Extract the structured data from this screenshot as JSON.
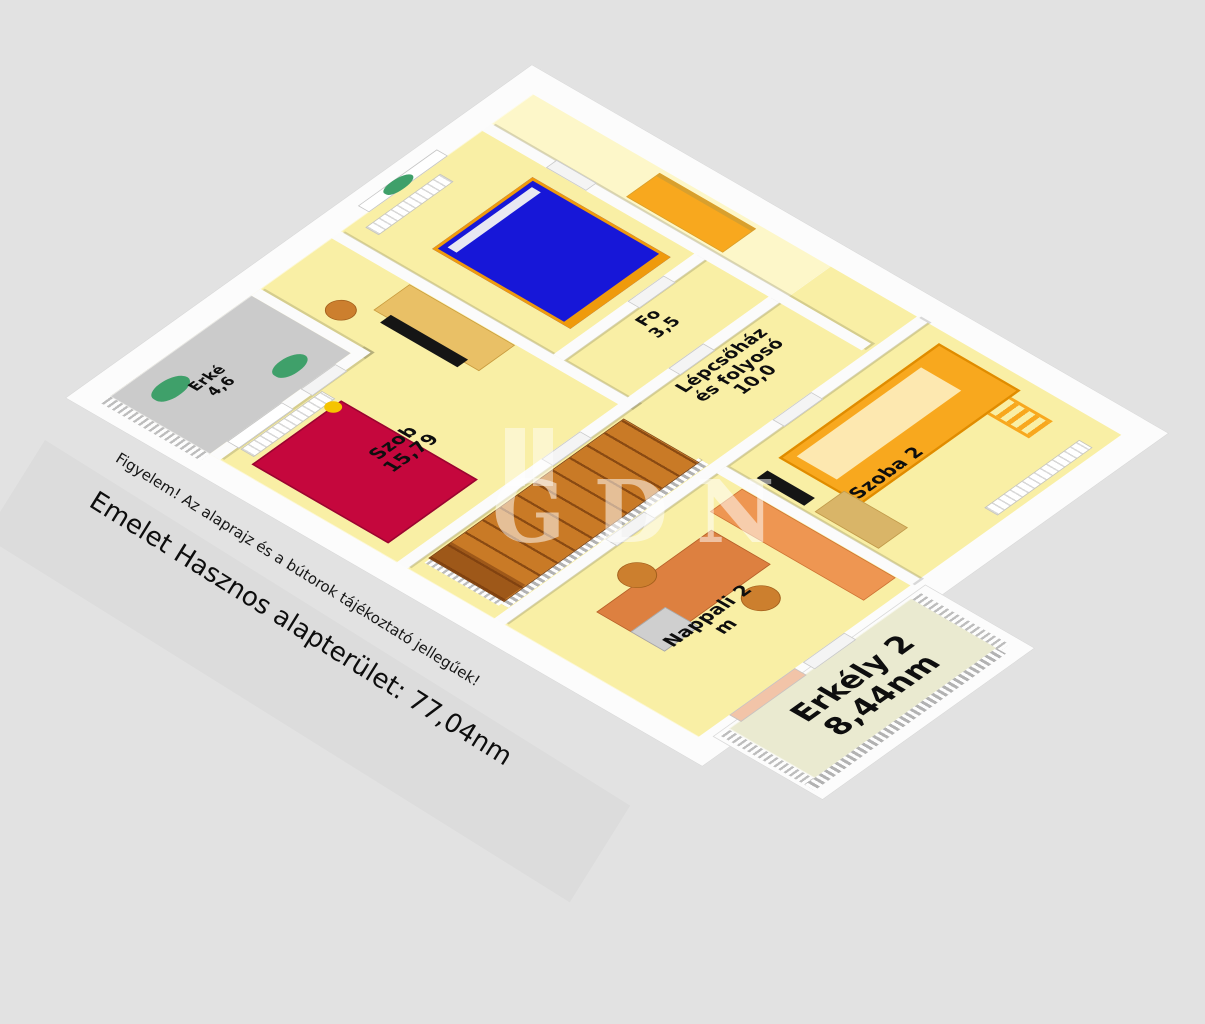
{
  "floorplan": {
    "watermark_text": "GDN",
    "notes": {
      "disclaimer": "Figyelem! Az alaprajz és a bútorok tájékoztató jellegűek!",
      "area_summary": "Emelet Hasznos alapterület: 77,04nm"
    },
    "rooms": [
      {
        "id": "erkely-1",
        "name": "Erké",
        "area": "4,6"
      },
      {
        "id": "szoba-1",
        "name": "Szob",
        "area": "15,79"
      },
      {
        "id": "fo",
        "name": "Fo",
        "area": "3,5"
      },
      {
        "id": "lepcsohaz",
        "name": "Lépcsőház",
        "name2": "és folyosó",
        "area": "10,0"
      },
      {
        "id": "szoba-2",
        "name": "Szoba 2",
        "area": ""
      },
      {
        "id": "nappali-2",
        "name": "Nappali 2",
        "area": "m"
      },
      {
        "id": "erkely-2",
        "name": "Erkély 2",
        "area": "8,44nm"
      }
    ],
    "colors": {
      "background": "#e2e2e2",
      "wall": "#fbfbfb",
      "floor": "#f9efa5",
      "floor_light": "#fdf7c9",
      "loggia_floor": "#cbcbcb",
      "balcony_floor": "#eaead0",
      "bed_blue": "#1717d8",
      "bed_red": "#c5073d",
      "pillow_yellow": "#f5c400",
      "loft_bed": "#f8a81e",
      "loft_mattress": "#fde8b0",
      "stairs_brown": "#c97a26",
      "desk_orange": "#dd8040",
      "sofa_orange": "#ee9652",
      "wood": "#e9c066",
      "mat_tan": "#d9b568",
      "drawer_gray": "#cfcfcf",
      "chair_orange": "#cc7f2e",
      "plant_green": "#3fa06a",
      "tv_black": "#151515",
      "accent_orange": "#ef9a0c",
      "curtain_peach": "#f2c4a8"
    }
  }
}
